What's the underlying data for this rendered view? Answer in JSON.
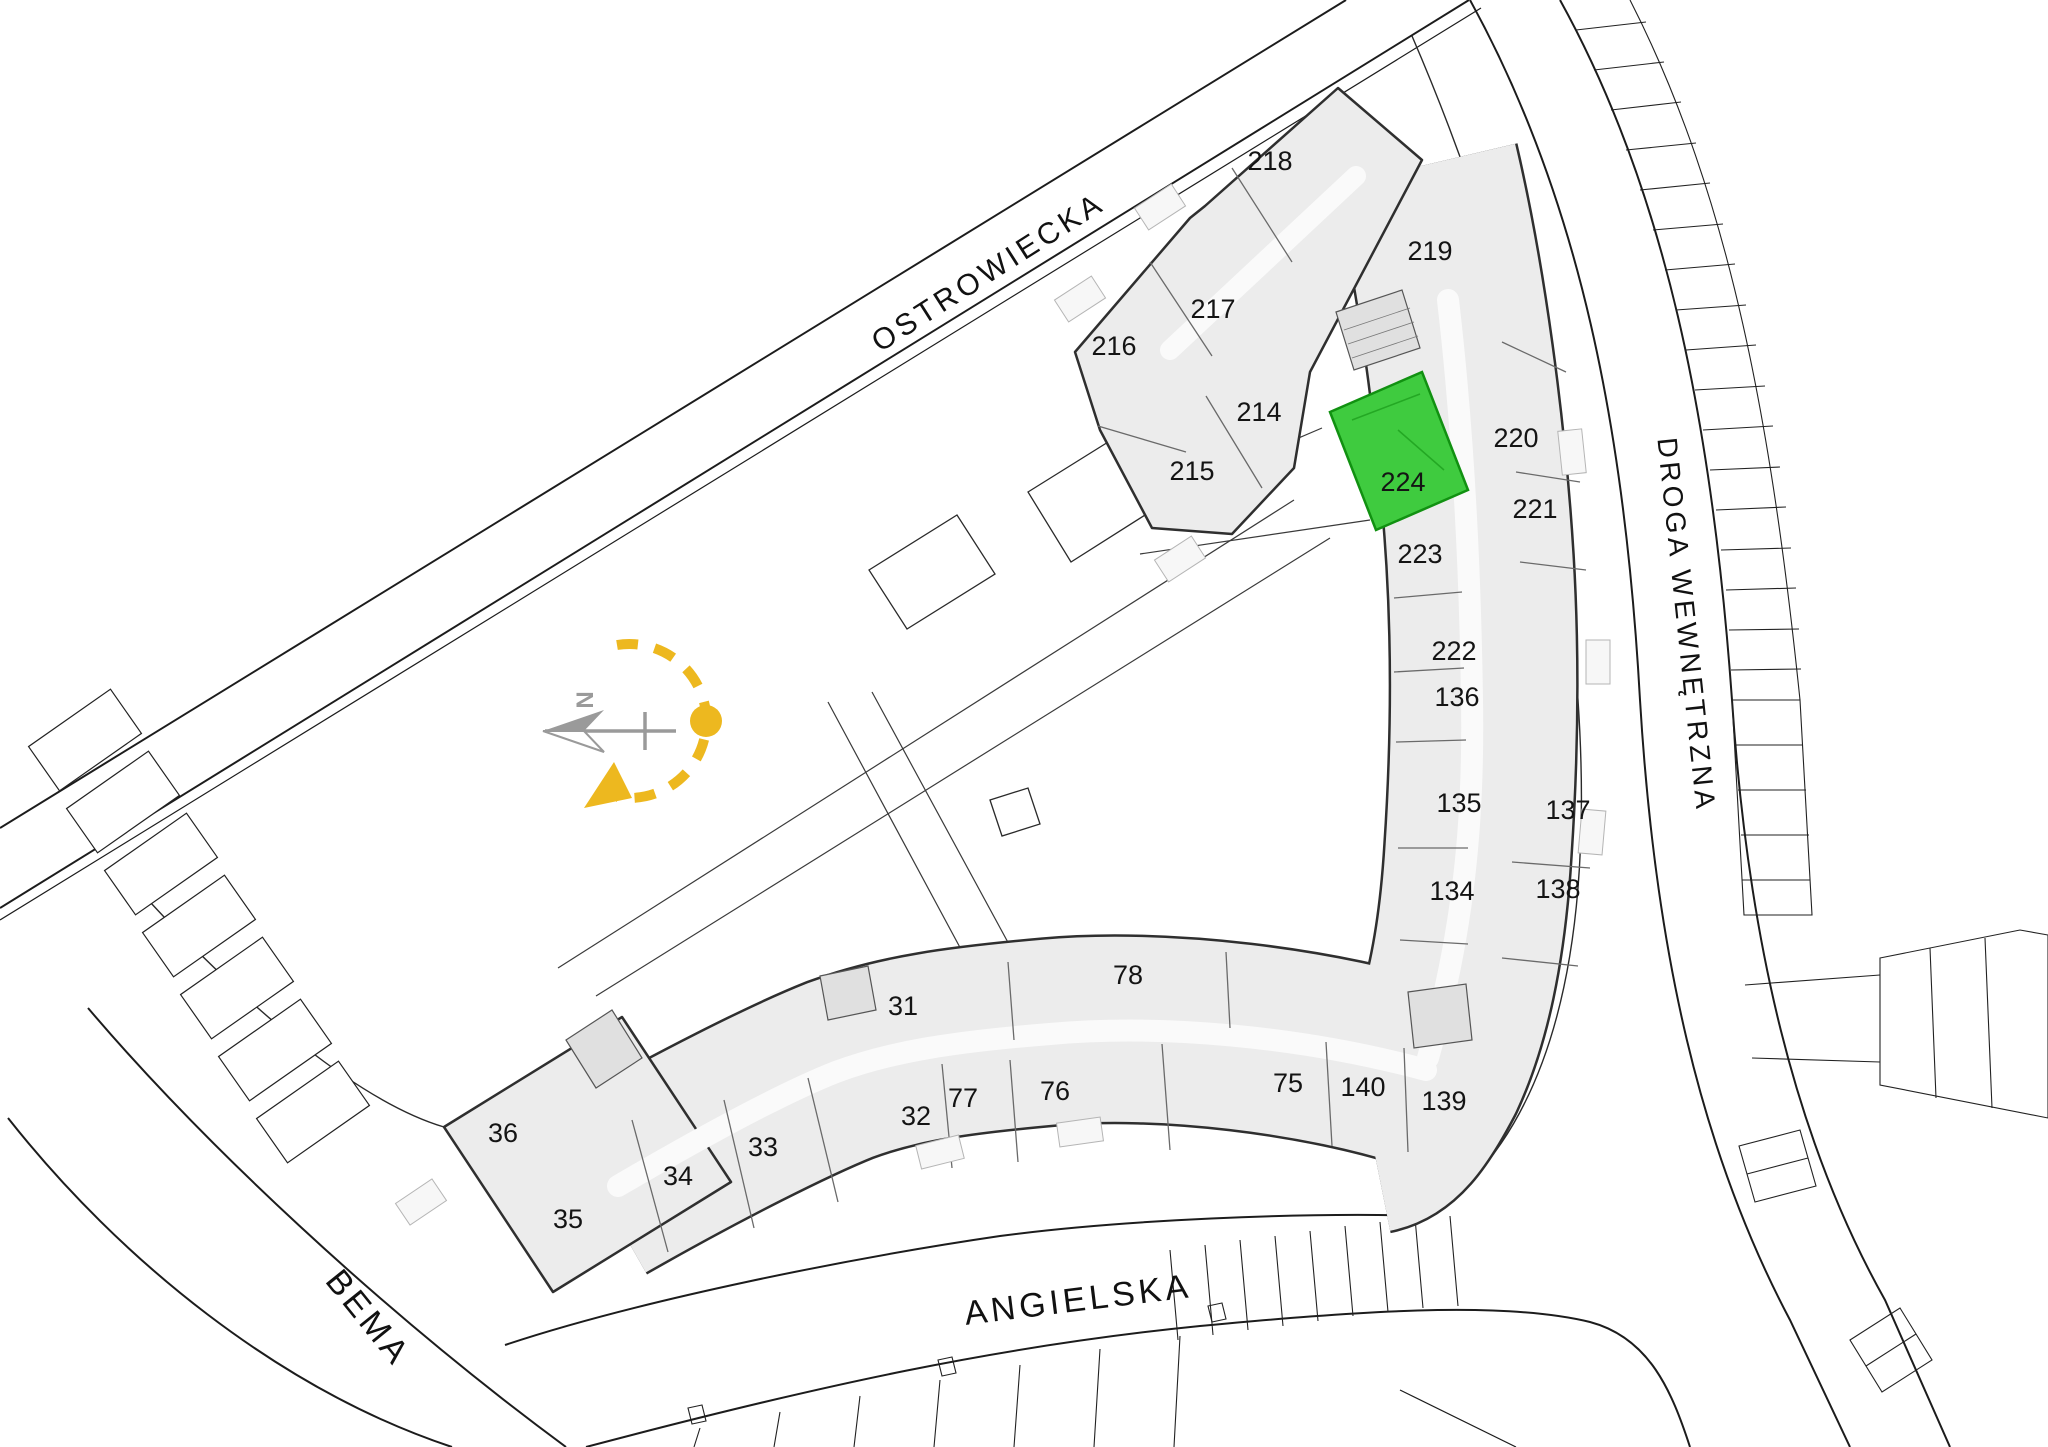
{
  "streets": {
    "ostrowiecka": "OSTROWIECKA",
    "droga_wewnetrzna": "DROGA WEWNĘTRZNA",
    "angielska": "ANGIELSKA",
    "bema": "BEMA"
  },
  "compass": {
    "north_label": "N"
  },
  "highlighted_unit": "224",
  "units": {
    "u218": "218",
    "u219": "219",
    "u217": "217",
    "u216": "216",
    "u214": "214",
    "u215": "215",
    "u220": "220",
    "u221": "221",
    "u224": "224",
    "u223": "223",
    "u222": "222",
    "u136": "136",
    "u135": "135",
    "u137": "137",
    "u134": "134",
    "u138": "138",
    "u139": "139",
    "u140": "140",
    "u75": "75",
    "u76": "76",
    "u77": "77",
    "u78": "78",
    "u31": "31",
    "u32": "32",
    "u33": "33",
    "u34": "34",
    "u35": "35",
    "u36": "36"
  },
  "colors": {
    "highlight_fill": "#3fcb3f",
    "highlight_stroke": "#119111",
    "highlight_inner": "#24a824",
    "highlight_text": "#0e7a12",
    "compass_yellow": "#edb81f",
    "compass_gray": "#9a9a9a"
  }
}
